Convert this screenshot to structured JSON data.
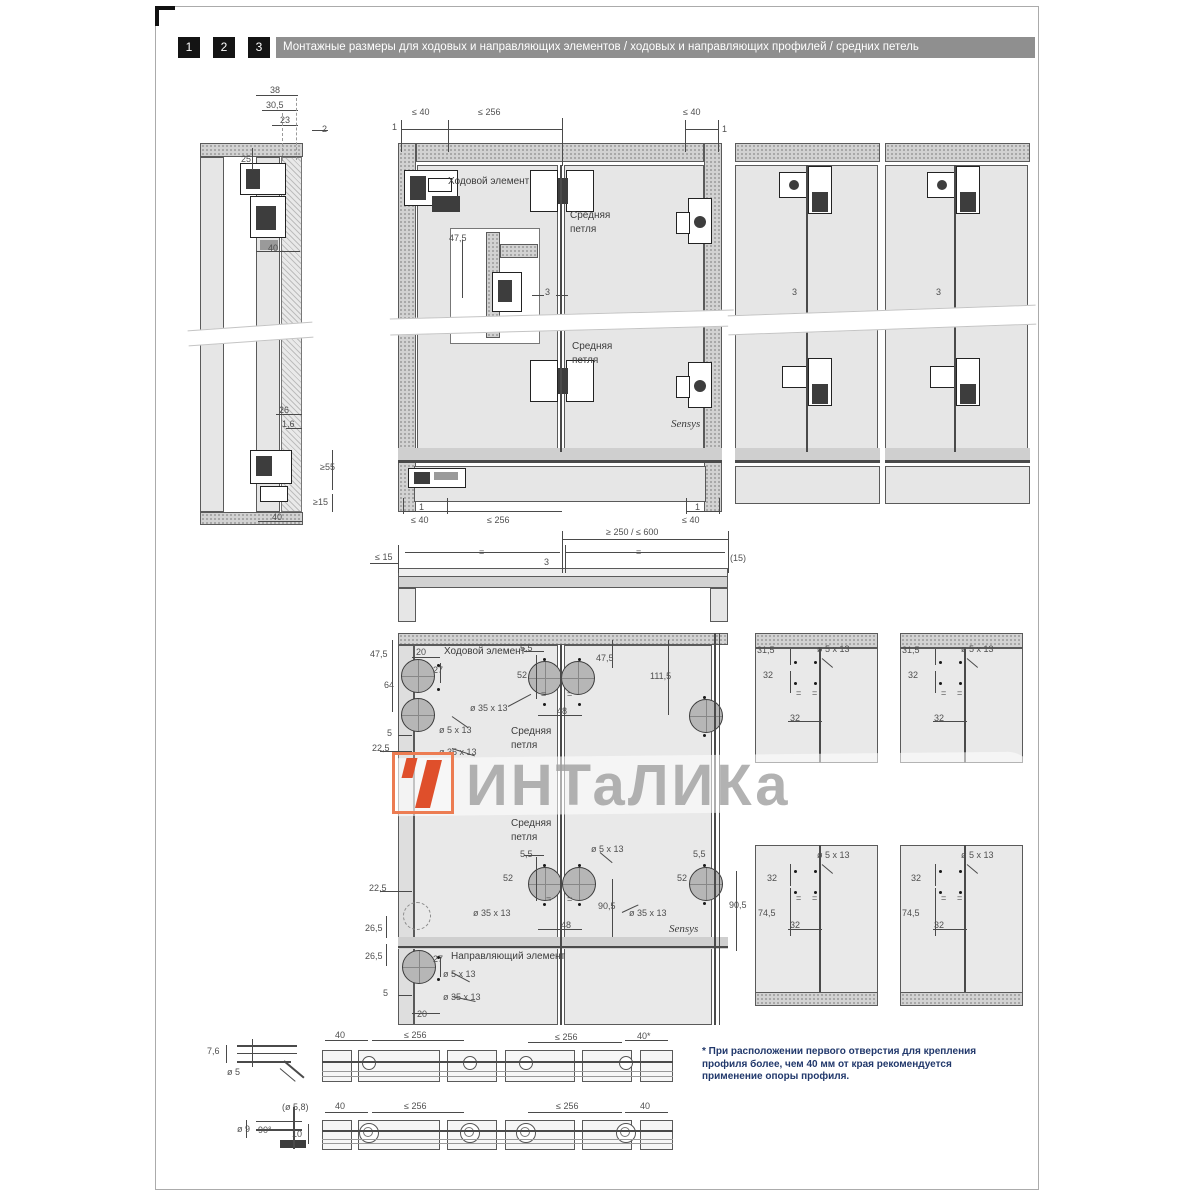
{
  "header": {
    "tabs": [
      "1",
      "2",
      "3"
    ],
    "title": "Монтажные размеры для ходовых и направляющих элементов / ходовых и направляющих профилей / средних петель"
  },
  "watermark": {
    "brand": "ИНТаЛИКа",
    "logo_color": "#df4f2b",
    "text_color": "#9f9f9f"
  },
  "footnote": {
    "lines": [
      "* При расположении первого отверстия для крепления",
      "профиля более, чем 40 мм от края рекомендуется",
      "применение опоры профиля."
    ]
  },
  "colors": {
    "header_bar": "#8f8f8f",
    "tab_box": "#141414",
    "panel": "#e6e6e6",
    "accent": "#df4f2b",
    "footnote_text": "#21386b"
  },
  "labels": [
    {
      "t": "38",
      "x": 270,
      "y": 85
    },
    {
      "t": "30,5",
      "x": 266,
      "y": 100
    },
    {
      "t": "23",
      "x": 280,
      "y": 115
    },
    {
      "t": "2",
      "x": 322,
      "y": 124
    },
    {
      "t": "25",
      "x": 241,
      "y": 154
    },
    {
      "t": "40",
      "x": 268,
      "y": 243
    },
    {
      "t": "26",
      "x": 279,
      "y": 405
    },
    {
      "t": "1,6",
      "x": 282,
      "y": 419
    },
    {
      "t": "≥55",
      "x": 320,
      "y": 462
    },
    {
      "t": "≥15",
      "x": 313,
      "y": 497
    },
    {
      "t": "40",
      "x": 272,
      "y": 512
    },
    {
      "t": "≤ 40",
      "x": 412,
      "y": 107
    },
    {
      "t": "≤ 256",
      "x": 478,
      "y": 107
    },
    {
      "t": "≤ 40",
      "x": 683,
      "y": 107
    },
    {
      "t": "1",
      "x": 392,
      "y": 122
    },
    {
      "t": "1",
      "x": 722,
      "y": 124
    },
    {
      "t": "Ходовой элемент",
      "x": 448,
      "y": 177,
      "c": "comp",
      "n": "label-running-element"
    },
    {
      "t": "Средняя",
      "x": 570,
      "y": 211,
      "c": "comp",
      "n": "label-middle-hinge"
    },
    {
      "t": "петля",
      "x": 570,
      "y": 225,
      "c": "comp"
    },
    {
      "t": "47,5",
      "x": 449,
      "y": 233
    },
    {
      "t": "3",
      "x": 545,
      "y": 287
    },
    {
      "t": "Средняя",
      "x": 572,
      "y": 342,
      "c": "comp",
      "n": "label-middle-hinge-2"
    },
    {
      "t": "петля",
      "x": 572,
      "y": 356,
      "c": "comp"
    },
    {
      "t": "Sensys",
      "x": 671,
      "y": 419,
      "c": "comp sensys",
      "n": "label-sensys"
    },
    {
      "t": "1",
      "x": 419,
      "y": 502
    },
    {
      "t": "≤ 40",
      "x": 411,
      "y": 515
    },
    {
      "t": "≤ 256",
      "x": 487,
      "y": 515
    },
    {
      "t": "1",
      "x": 695,
      "y": 502
    },
    {
      "t": "≤ 40",
      "x": 682,
      "y": 515
    },
    {
      "t": "≥ 250 / ≤ 600",
      "x": 606,
      "y": 527
    },
    {
      "t": "3",
      "x": 792,
      "y": 287
    },
    {
      "t": "3",
      "x": 936,
      "y": 287
    },
    {
      "t": "≤ 15",
      "x": 375,
      "y": 552
    },
    {
      "t": "=",
      "x": 479,
      "y": 547
    },
    {
      "t": "3",
      "x": 544,
      "y": 557
    },
    {
      "t": "=",
      "x": 636,
      "y": 547
    },
    {
      "t": "(15)",
      "x": 730,
      "y": 553
    },
    {
      "t": "47,5",
      "x": 370,
      "y": 649
    },
    {
      "t": "20",
      "x": 416,
      "y": 647
    },
    {
      "t": "Ходовой элемент",
      "x": 444,
      "y": 647,
      "c": "comp",
      "n": "label-running-element-2"
    },
    {
      "t": "5,5",
      "x": 520,
      "y": 643
    },
    {
      "t": "27",
      "x": 433,
      "y": 665
    },
    {
      "t": "52",
      "x": 517,
      "y": 670
    },
    {
      "t": "47,5",
      "x": 596,
      "y": 653
    },
    {
      "t": "111,5",
      "x": 650,
      "y": 671
    },
    {
      "t": "64",
      "x": 384,
      "y": 680
    },
    {
      "t": "ø 35 x 13",
      "x": 470,
      "y": 703
    },
    {
      "t": "48",
      "x": 557,
      "y": 706
    },
    {
      "t": "=",
      "x": 541,
      "y": 689
    },
    {
      "t": "=",
      "x": 567,
      "y": 689
    },
    {
      "t": "5",
      "x": 387,
      "y": 728
    },
    {
      "t": "ø 5 x 13",
      "x": 439,
      "y": 725
    },
    {
      "t": "22,5",
      "x": 372,
      "y": 743
    },
    {
      "t": "Средняя",
      "x": 511,
      "y": 727,
      "c": "comp",
      "n": "label-middle-hinge-3"
    },
    {
      "t": "петля",
      "x": 511,
      "y": 741,
      "c": "comp"
    },
    {
      "t": "ø 35 x 13",
      "x": 439,
      "y": 747
    },
    {
      "t": "Средняя",
      "x": 511,
      "y": 819,
      "c": "comp",
      "n": "label-middle-hinge-4"
    },
    {
      "t": "петля",
      "x": 511,
      "y": 833,
      "c": "comp"
    },
    {
      "t": "5,5",
      "x": 520,
      "y": 849
    },
    {
      "t": "ø 5 x 13",
      "x": 591,
      "y": 844
    },
    {
      "t": "52",
      "x": 503,
      "y": 873
    },
    {
      "t": "ø 35 x 13",
      "x": 473,
      "y": 908
    },
    {
      "t": "48",
      "x": 561,
      "y": 920
    },
    {
      "t": "=",
      "x": 546,
      "y": 894
    },
    {
      "t": "=",
      "x": 567,
      "y": 894
    },
    {
      "t": "90,5",
      "x": 598,
      "y": 901
    },
    {
      "t": "5,5",
      "x": 693,
      "y": 849
    },
    {
      "t": "52",
      "x": 677,
      "y": 873
    },
    {
      "t": "ø 35 x 13",
      "x": 629,
      "y": 908
    },
    {
      "t": "Sensys",
      "x": 669,
      "y": 924,
      "c": "comp sensys",
      "n": "label-sensys-2"
    },
    {
      "t": "90,5",
      "x": 729,
      "y": 900
    },
    {
      "t": "22,5",
      "x": 369,
      "y": 883
    },
    {
      "t": "26,5",
      "x": 365,
      "y": 923
    },
    {
      "t": "26,5",
      "x": 365,
      "y": 951
    },
    {
      "t": "27",
      "x": 433,
      "y": 954
    },
    {
      "t": "Направляющий элемент",
      "x": 451,
      "y": 952,
      "c": "comp",
      "n": "label-guide-element"
    },
    {
      "t": "ø 5 x 13",
      "x": 443,
      "y": 969
    },
    {
      "t": "5",
      "x": 383,
      "y": 988
    },
    {
      "t": "ø 35 x 13",
      "x": 443,
      "y": 992
    },
    {
      "t": "20",
      "x": 417,
      "y": 1009
    },
    {
      "t": "31,5",
      "x": 757,
      "y": 645
    },
    {
      "t": "ø 5 x 13",
      "x": 817,
      "y": 644
    },
    {
      "t": "32",
      "x": 763,
      "y": 670
    },
    {
      "t": "=",
      "x": 796,
      "y": 688
    },
    {
      "t": "=",
      "x": 812,
      "y": 688
    },
    {
      "t": "32",
      "x": 790,
      "y": 713
    },
    {
      "t": "31,5",
      "x": 902,
      "y": 645
    },
    {
      "t": "ø 5 x 13",
      "x": 961,
      "y": 644
    },
    {
      "t": "32",
      "x": 908,
      "y": 670
    },
    {
      "t": "=",
      "x": 941,
      "y": 688
    },
    {
      "t": "=",
      "x": 957,
      "y": 688
    },
    {
      "t": "32",
      "x": 934,
      "y": 713
    },
    {
      "t": "32",
      "x": 767,
      "y": 873
    },
    {
      "t": "ø 5 x 13",
      "x": 817,
      "y": 850
    },
    {
      "t": "74,5",
      "x": 758,
      "y": 908
    },
    {
      "t": "=",
      "x": 796,
      "y": 893
    },
    {
      "t": "=",
      "x": 812,
      "y": 893
    },
    {
      "t": "32",
      "x": 790,
      "y": 920
    },
    {
      "t": "32",
      "x": 911,
      "y": 873
    },
    {
      "t": "ø 5 x 13",
      "x": 961,
      "y": 850
    },
    {
      "t": "74,5",
      "x": 902,
      "y": 908
    },
    {
      "t": "=",
      "x": 941,
      "y": 893
    },
    {
      "t": "=",
      "x": 957,
      "y": 893
    },
    {
      "t": "32",
      "x": 934,
      "y": 920
    },
    {
      "t": "7,6",
      "x": 207,
      "y": 1046
    },
    {
      "t": "ø 5",
      "x": 227,
      "y": 1067
    },
    {
      "t": "(ø 5,8)",
      "x": 282,
      "y": 1102
    },
    {
      "t": "ø 9",
      "x": 237,
      "y": 1124
    },
    {
      "t": "90°",
      "x": 258,
      "y": 1125
    },
    {
      "t": "10",
      "x": 292,
      "y": 1129
    },
    {
      "t": "40",
      "x": 335,
      "y": 1030
    },
    {
      "t": "≤ 256",
      "x": 404,
      "y": 1030
    },
    {
      "t": "≤ 256",
      "x": 555,
      "y": 1032
    },
    {
      "t": "40*",
      "x": 637,
      "y": 1031
    },
    {
      "t": "40",
      "x": 335,
      "y": 1101
    },
    {
      "t": "≤ 256",
      "x": 404,
      "y": 1101
    },
    {
      "t": "≤ 256",
      "x": 556,
      "y": 1101
    },
    {
      "t": "40",
      "x": 640,
      "y": 1101
    }
  ]
}
